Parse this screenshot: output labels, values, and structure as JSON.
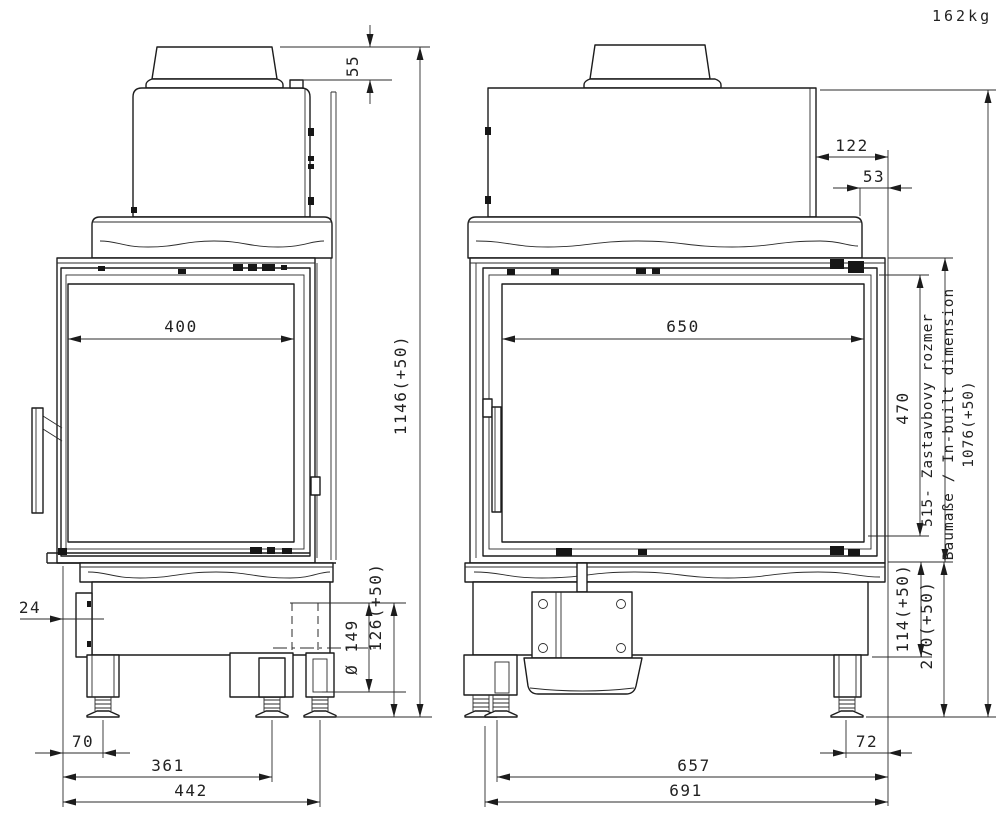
{
  "sheet": {
    "weight": "162kg"
  },
  "left_view": {
    "flue_height_offset": "55",
    "glass_width": "400",
    "overall_height": "1146(+50)",
    "flue_outlet_diameter": "Ø 149",
    "outlet_bottom_height": "126(+50)",
    "control_box_offset": "24",
    "leg_front_offset": "70",
    "leg_mid_span": "361",
    "overall_width": "442"
  },
  "right_view": {
    "rear_panel_offset": "122",
    "flue_center_offset": "53",
    "glass_width": "650",
    "glass_height": "470",
    "inbuilt_note_sk": "515- Zastavbovy rozmer",
    "inbuilt_note_de_en": "Baumaße / In-built dimension",
    "inbuilt_height": "1076(+50)",
    "base_height": "114(+50)",
    "bottom_clearance": "270(+50)",
    "leg_rear_offset": "72",
    "leg_span": "657",
    "overall_width": "691"
  }
}
